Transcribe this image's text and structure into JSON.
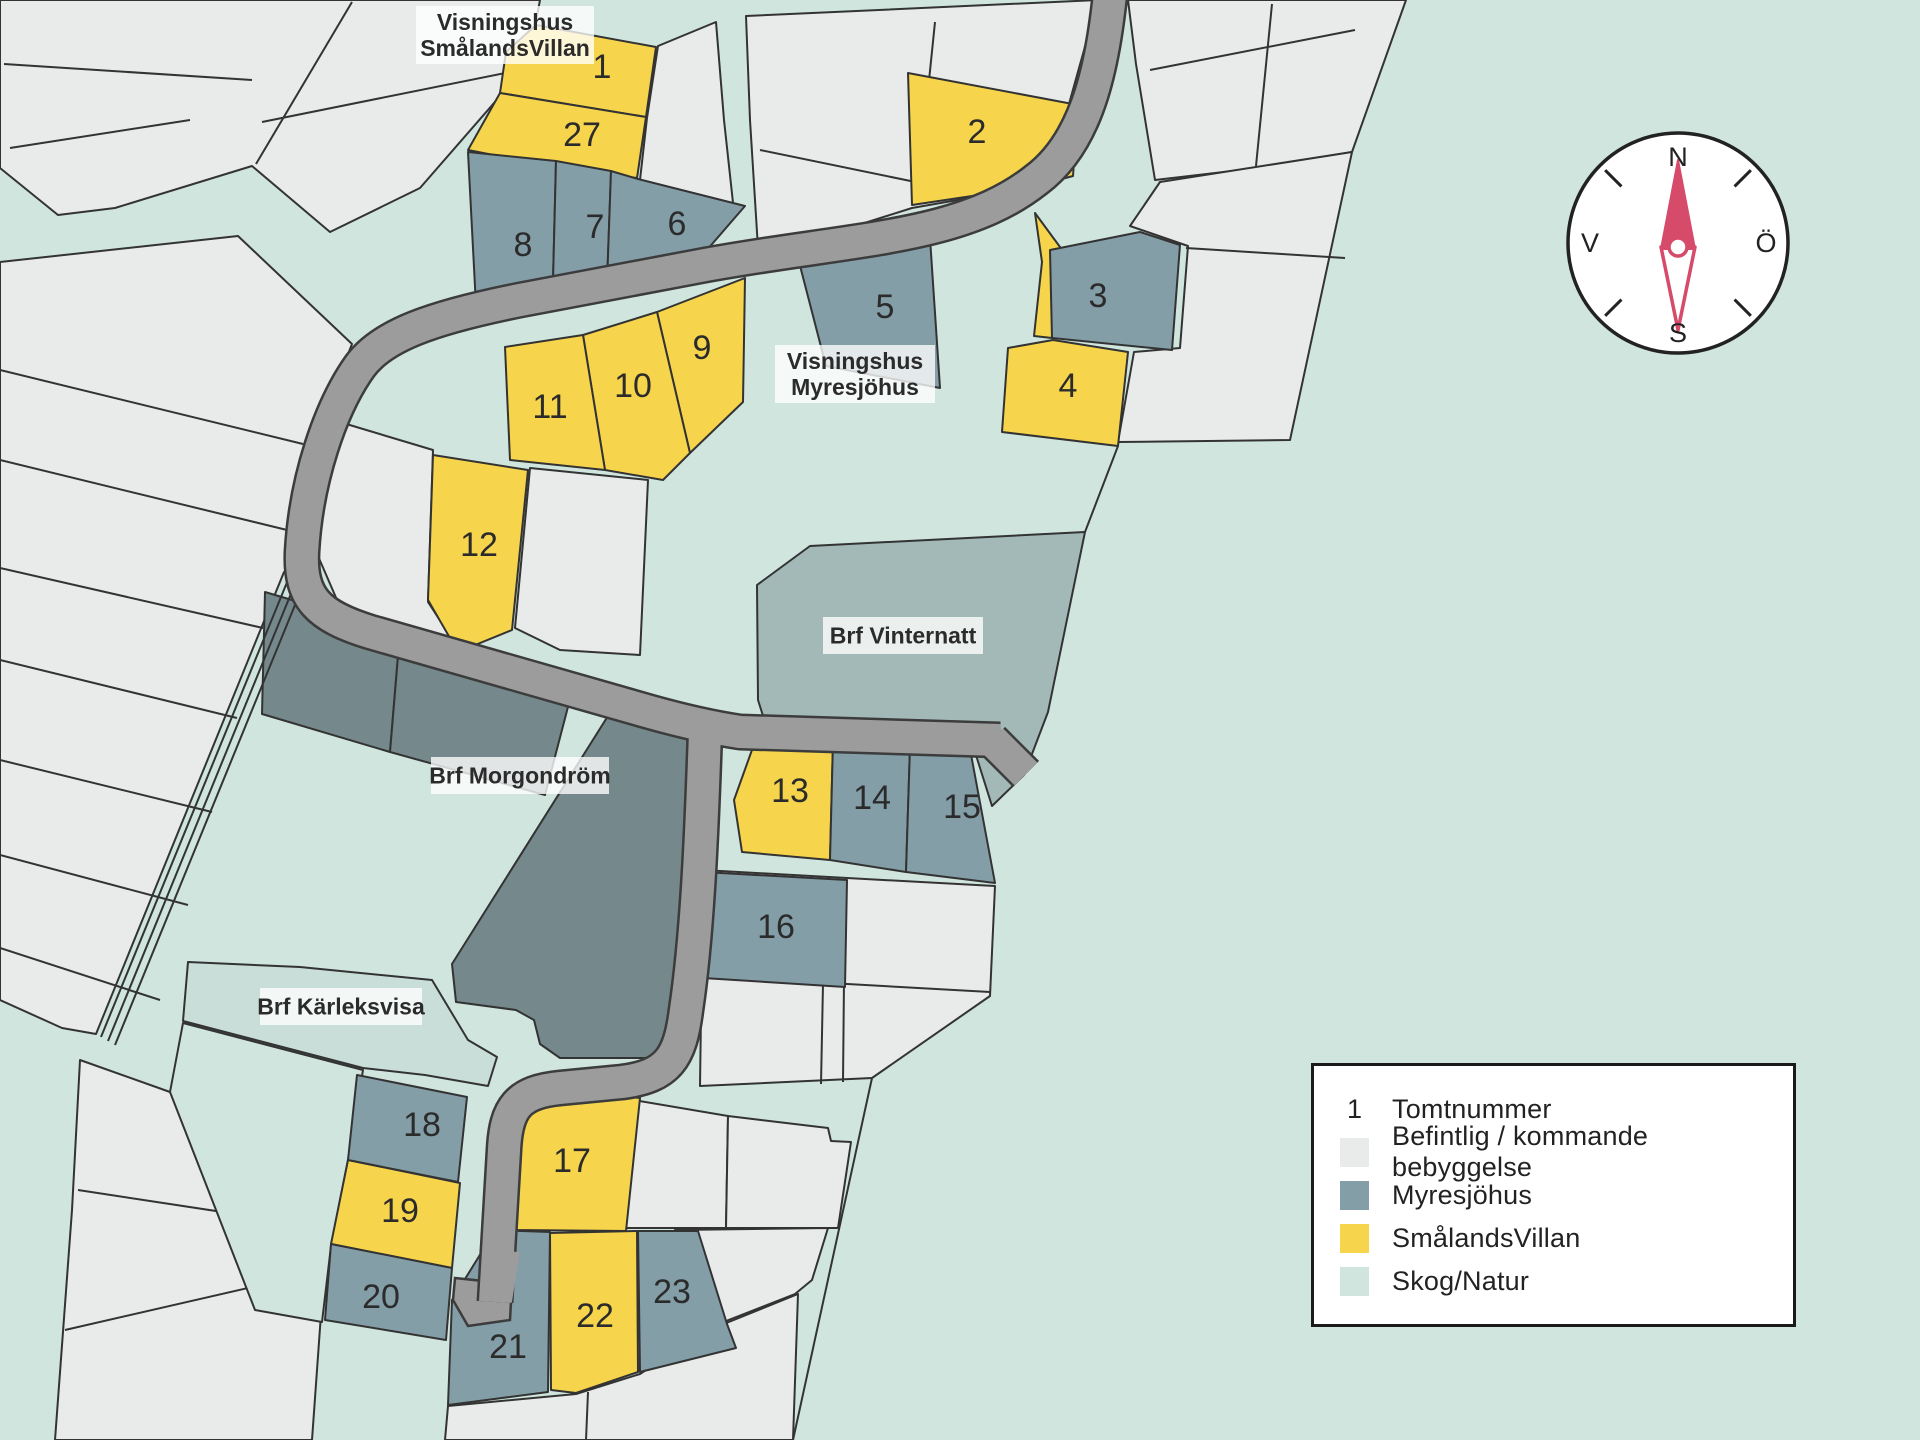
{
  "map": {
    "background": "#cfe5de",
    "palette": {
      "white_lot": "#e9eaea",
      "myresjohus": "#849ea8",
      "smalandsvillan": "#f6d54c",
      "skog_natur": "#cfe5de",
      "vinternatt": "#a2b9b8",
      "morgondrom": "#75888b",
      "karleksvisa": "#c9ded8",
      "road_fill": "#9c9c9c",
      "road_edge": "#3c3c3c",
      "outline": "#333333",
      "text": "#2b2b2b",
      "label_bg": "rgba(255,255,255,0.78)",
      "needle": "#d64a6a"
    },
    "white_clusters": [
      {
        "name": "cluster-top-left",
        "points": "0,0 540,0 528,64 420,188 330,232 252,166 115,208 58,215 0,168",
        "lines": [
          [
            352,
            2,
            256,
            164
          ],
          [
            4,
            64,
            252,
            80
          ],
          [
            10,
            148,
            190,
            120
          ],
          [
            262,
            122,
            520,
            70
          ]
        ]
      },
      {
        "name": "cluster-top-center",
        "points": "746,16 1098,0 1050,172 1032,187 912,208 836,232 758,248 750,120",
        "lines": [
          [
            760,
            150,
            930,
            185
          ],
          [
            935,
            22,
            918,
            188
          ]
        ]
      },
      {
        "name": "cluster-top-right",
        "points": "1128,0 1406,0 1352,152 1258,168 1155,180 1136,64",
        "lines": [
          [
            1150,
            70,
            1355,
            30
          ],
          [
            1272,
            4,
            1256,
            166
          ]
        ]
      },
      {
        "name": "cluster-right-34",
        "points": "1160,182 1352,152 1290,440 1118,442 1134,352 1180,348 1188,246 1130,226",
        "lines": [
          [
            1186,
            248,
            1345,
            258
          ]
        ]
      },
      {
        "name": "cluster-mid-west",
        "points": "333,420 433,450 428,602 458,648 350,630 318,556",
        "lines": []
      },
      {
        "name": "cluster-mid-east",
        "points": "530,468 648,480 640,655 560,650 515,628",
        "lines": []
      },
      {
        "name": "cluster-east-of-lots1-27",
        "points": "658,46 716,22 724,120 734,212 640,180 647,118",
        "lines": []
      },
      {
        "name": "cluster-left-strips",
        "points": "0,262 238,236 352,344 322,420 303,498 296,565 284,572 96,1034 62,1028 0,1000",
        "lines": [
          [
            0,
            370,
            303,
            444
          ],
          [
            0,
            460,
            287,
            530
          ],
          [
            0,
            568,
            263,
            628
          ],
          [
            0,
            660,
            237,
            718
          ],
          [
            0,
            760,
            212,
            812
          ],
          [
            0,
            855,
            188,
            905
          ],
          [
            0,
            948,
            160,
            1000
          ]
        ]
      },
      {
        "name": "cluster-16",
        "points": "703,870 847,878 995,886 990,996 872,1078 700,1086",
        "lines": [
          [
            845,
            880,
            843,
            1082
          ],
          [
            703,
            976,
            990,
            992
          ],
          [
            823,
            984,
            821,
            1084
          ]
        ]
      },
      {
        "name": "cluster-bottom-row1-a",
        "points": "622,1098 728,1116 726,1228 622,1228",
        "lines": []
      },
      {
        "name": "cluster-bottom-row1-b",
        "points": "728,1116 828,1128 831,1141 851,1142 838,1228 726,1228",
        "lines": []
      },
      {
        "name": "cluster-bottom-row2",
        "points": "675,1230 828,1228 812,1280 795,1294 703,1330 694,1292",
        "lines": []
      },
      {
        "name": "cluster-bottom-big",
        "points": "448,1406 576,1394 640,1374 704,1332 798,1294 793,1440 445,1440",
        "lines": [
          [
            588,
            1392,
            586,
            1440
          ]
        ]
      },
      {
        "name": "cluster-bottom-left",
        "points": "80,1060 170,1092 322,1300 312,1440 55,1440 72,1210",
        "lines": [
          [
            78,
            1190,
            262,
            1218
          ],
          [
            65,
            1330,
            300,
            1276
          ]
        ]
      }
    ],
    "areas": [
      {
        "name": "brf-vinternatt",
        "color": "vinternatt",
        "points": "757,585 810,546 1085,532 1048,712 1024,775 992,806 975,752 770,738 758,700"
      },
      {
        "name": "brf-morgondrom-1",
        "color": "morgondrom",
        "points": "265,592 400,632 390,752 262,714"
      },
      {
        "name": "brf-morgondrom-2",
        "color": "morgondrom",
        "points": "400,632 575,680 545,795 390,752"
      },
      {
        "name": "brf-morgondrom-3",
        "color": "morgondrom",
        "points": "618,700 690,726 683,1020 676,1048 652,1058 560,1058 540,1044 534,1020 516,1010 456,1002 452,964"
      },
      {
        "name": "brf-karleksvisa",
        "color": "karleksvisa",
        "points": "188,962 300,967 432,980 468,1040 497,1057 488,1086 425,1075 363,1068 183,1021"
      },
      {
        "name": "skog-enclave",
        "color": "skog_natur",
        "points": "183,1023 363,1070 348,1160 331,1246 322,1322 255,1310 170,1092"
      }
    ],
    "boundary_lines": [
      {
        "name": "east-boundary-corridor",
        "points": "872,1078 793,1440"
      },
      {
        "name": "east-boundary-upper",
        "points": "1118,446 1085,532"
      },
      {
        "name": "left-path-1",
        "points": "290,575 101,1037"
      },
      {
        "name": "left-path-2",
        "points": "297,579 108,1041"
      },
      {
        "name": "left-path-3",
        "points": "304,583 115,1045"
      }
    ],
    "roads": {
      "paths": [
        {
          "name": "road-main",
          "d": "M1112,-25 C1104,60 1090,140 1036,180 C960,240 850,238 700,266 L520,300 C430,318 382,336 360,366 C330,408 306,480 302,552 C300,598 318,616 370,632 L650,712 Q700,726 740,732 L1000,740"
        },
        {
          "name": "road-south-branch",
          "d": "M705,732 C702,820 698,930 686,1010 C680,1058 668,1076 622,1082 L560,1088 C518,1092 506,1108 504,1150 L495,1302"
        },
        {
          "name": "road-se-stub",
          "d": "M992,740 L1026,774"
        }
      ],
      "dead_end_points": "455,1278 512,1284 510,1320 468,1326 453,1300",
      "patches": [
        {
          "d": "M504,1250 L496,1300"
        }
      ]
    },
    "lots": [
      {
        "number": "1",
        "type": "smalandsvillan",
        "points": "506,52 536,25 656,47 646,117 500,93",
        "lx": 602,
        "ly": 67
      },
      {
        "number": "27",
        "type": "smalandsvillan",
        "points": "500,93 646,117 637,178 560,168 468,150",
        "lx": 582,
        "ly": 135
      },
      {
        "number": "2",
        "type": "smalandsvillan",
        "points": "908,73 1078,105 1073,176 1032,187 912,205",
        "lx": 977,
        "ly": 132
      },
      {
        "number": "4",
        "type": "smalandsvillan",
        "points": "1008,348 1053,340 1128,352 1118,446 1002,432",
        "points2": "1035,213 1060,247 1052,338 1034,336 1042,262",
        "lx": 1068,
        "ly": 386
      },
      {
        "number": "9",
        "type": "smalandsvillan",
        "points": "657,312 745,278 743,402 690,453",
        "lx": 702,
        "ly": 348
      },
      {
        "number": "10",
        "type": "smalandsvillan",
        "points": "583,335 657,312 690,453 663,480 605,470",
        "lx": 633,
        "ly": 386
      },
      {
        "number": "11",
        "type": "smalandsvillan",
        "points": "505,347 583,335 605,470 510,460",
        "lx": 550,
        "ly": 407
      },
      {
        "number": "12",
        "type": "smalandsvillan",
        "points": "433,455 528,470 512,630 458,652 428,600",
        "lx": 479,
        "ly": 545
      },
      {
        "number": "13",
        "type": "smalandsvillan",
        "points": "757,736 833,741 830,860 742,852 734,800",
        "lx": 790,
        "ly": 791
      },
      {
        "number": "17",
        "type": "smalandsvillan",
        "points": "513,1230 512,1112 520,1094 537,1088 640,1098 626,1231",
        "lx": 572,
        "ly": 1161
      },
      {
        "number": "19",
        "type": "smalandsvillan",
        "points": "348,1160 460,1183 452,1268 331,1244",
        "lx": 400,
        "ly": 1211
      },
      {
        "number": "22",
        "type": "smalandsvillan",
        "points": "550,1233 637,1231 638,1372 576,1393 551,1390",
        "lx": 595,
        "ly": 1316
      },
      {
        "number": "8",
        "type": "myresjohus",
        "points": "468,152 556,161 553,281 533,297 476,306",
        "lx": 523,
        "ly": 245
      },
      {
        "number": "7",
        "type": "myresjohus",
        "points": "556,161 611,171 607,284 553,281",
        "lx": 595,
        "ly": 227
      },
      {
        "number": "6",
        "type": "myresjohus",
        "points": "611,171 638,179 745,206 700,258 636,282 607,284",
        "lx": 677,
        "ly": 224
      },
      {
        "number": "5",
        "type": "myresjohus",
        "points": "798,258 930,238 940,388 826,366",
        "lx": 885,
        "ly": 307
      },
      {
        "number": "3",
        "type": "myresjohus",
        "points": "1050,250 1140,232 1180,245 1172,350 1052,338",
        "lx": 1098,
        "ly": 296
      },
      {
        "number": "14",
        "type": "myresjohus",
        "points": "833,741 910,747 906,872 830,860",
        "lx": 872,
        "ly": 798
      },
      {
        "number": "15",
        "type": "myresjohus",
        "points": "910,747 970,749 995,883 906,872",
        "lx": 962,
        "ly": 807
      },
      {
        "number": "16",
        "type": "myresjohus",
        "points": "703,872 847,880 845,987 703,978",
        "lx": 776,
        "ly": 927
      },
      {
        "number": "18",
        "type": "myresjohus",
        "points": "357,1075 467,1097 458,1182 348,1160",
        "lx": 422,
        "ly": 1125
      },
      {
        "number": "20",
        "type": "myresjohus",
        "points": "331,1244 452,1268 446,1340 325,1320",
        "lx": 381,
        "ly": 1297
      },
      {
        "number": "21",
        "type": "myresjohus",
        "points": "495,1230 550,1232 548,1392 448,1405 452,1300 478,1258",
        "lx": 508,
        "ly": 1347
      },
      {
        "number": "23",
        "type": "myresjohus",
        "points": "638,1231 698,1231 727,1324 736,1348 640,1372",
        "lx": 672,
        "ly": 1292
      }
    ],
    "area_labels": [
      {
        "name": "label-visningshus-smalandsvillan",
        "x": 416,
        "y": 6,
        "w": 178,
        "h": 58,
        "lines": [
          "Visningshus",
          "SmålandsVillan"
        ]
      },
      {
        "name": "label-visningshus-myresjohus",
        "x": 775,
        "y": 345,
        "w": 160,
        "h": 58,
        "lines": [
          "Visningshus",
          "Myresjöhus"
        ]
      },
      {
        "name": "label-brf-vinternatt",
        "x": 823,
        "y": 617,
        "w": 160,
        "h": 37,
        "lines": [
          "Brf Vinternatt"
        ]
      },
      {
        "name": "label-brf-morgondrom",
        "x": 431,
        "y": 757,
        "w": 178,
        "h": 37,
        "lines": [
          "Brf Morgondröm"
        ]
      },
      {
        "name": "label-brf-karleksvisa",
        "x": 260,
        "y": 988,
        "w": 162,
        "h": 37,
        "lines": [
          "Brf Kärleksvisa"
        ]
      }
    ]
  },
  "compass": {
    "cx": 1678,
    "cy": 243,
    "r": 110,
    "n": "N",
    "e": "Ö",
    "s": "S",
    "w": "V"
  },
  "legend": {
    "number_symbol": "1",
    "items": [
      {
        "swatch": "number",
        "label": "Tomtnummer"
      },
      {
        "swatch": "#e9eaea",
        "label": "Befintlig / kommande bebyggelse"
      },
      {
        "swatch": "#849ea8",
        "label": "Myresjöhus"
      },
      {
        "swatch": "#f6d54c",
        "label": "SmålandsVillan"
      },
      {
        "swatch": "#cfe5de",
        "label": "Skog/Natur"
      }
    ]
  }
}
